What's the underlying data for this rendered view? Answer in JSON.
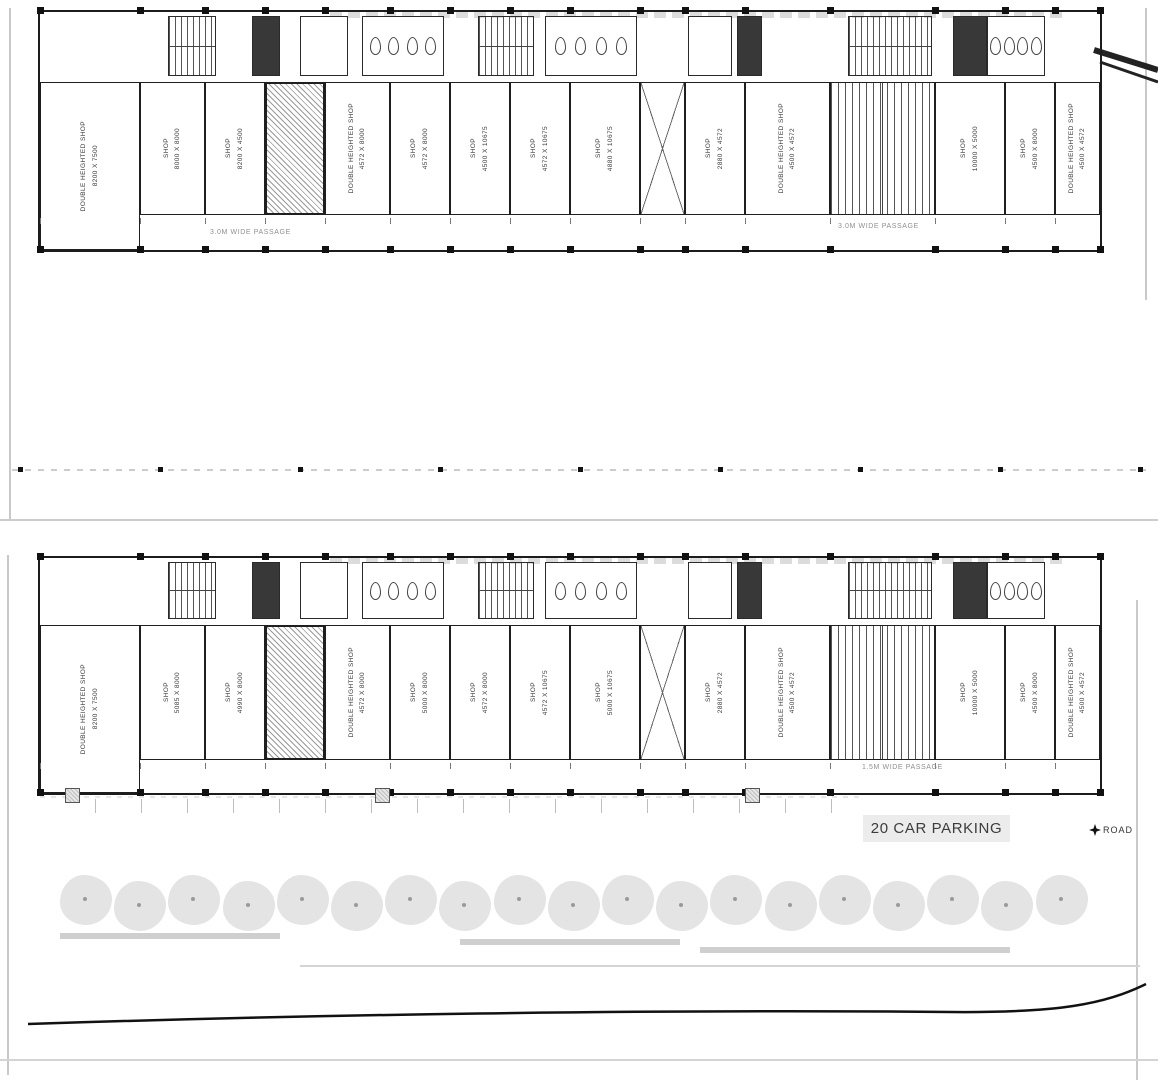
{
  "meta": {
    "drawing_type": "architectural floor plan",
    "description": "Two stacked floor plans of a commercial shop row building with stairs, lifts, toilets, front passage, car parking, tree line and road"
  },
  "colors": {
    "wall": "#1c1c1c",
    "boundary": "#c9c9c9",
    "tree_fill": "#e4e4e4",
    "label_text": "#3a3a3a",
    "passage_text": "#8f8f8f"
  },
  "floors": [
    {
      "name": "upper floor plan",
      "units": [
        {
          "type": "shop-dh",
          "label": "DOUBLE HEIGHTED SHOP",
          "dim": "8200 X 7500"
        },
        {
          "type": "shop",
          "label": "SHOP",
          "dim": "8000 X 8000"
        },
        {
          "type": "shop",
          "label": "SHOP",
          "dim": "8200 X 4500"
        },
        {
          "type": "lift",
          "label": "",
          "dim": ""
        },
        {
          "type": "shop-dh",
          "label": "DOUBLE HEIGHTED SHOP",
          "dim": "4572 X 8000"
        },
        {
          "type": "shop",
          "label": "SHOP",
          "dim": "4572 X 8000"
        },
        {
          "type": "shop",
          "label": "SHOP",
          "dim": "4500 X 10675"
        },
        {
          "type": "shop",
          "label": "SHOP",
          "dim": "4572 X 10675"
        },
        {
          "type": "shop",
          "label": "SHOP",
          "dim": "4880 X 10675"
        },
        {
          "type": "entry",
          "label": "",
          "dim": ""
        },
        {
          "type": "shop",
          "label": "SHOP",
          "dim": "2880 X 4572"
        },
        {
          "type": "shop-dh",
          "label": "DOUBLE HEIGHTED SHOP",
          "dim": "4500 X 4572"
        },
        {
          "type": "stair",
          "label": "",
          "dim": ""
        },
        {
          "type": "shop",
          "label": "SHOP",
          "dim": "10000 X 5000"
        },
        {
          "type": "shop",
          "label": "SHOP",
          "dim": "4500 X 8000"
        },
        {
          "type": "shop-dh",
          "label": "DOUBLE HEIGHTED SHOP",
          "dim": "4500 X 4572"
        }
      ],
      "passage_labels": [
        "3.0M WIDE PASSAGE",
        "3.0M WIDE PASSAGE"
      ]
    },
    {
      "name": "ground floor plan",
      "units": [
        {
          "type": "shop-dh",
          "label": "DOUBLE HEIGHTED SHOP",
          "dim": "8200 X 7500"
        },
        {
          "type": "shop",
          "label": "SHOP",
          "dim": "5085 X 8000"
        },
        {
          "type": "shop",
          "label": "SHOP",
          "dim": "4990 X 8000"
        },
        {
          "type": "lift",
          "label": "",
          "dim": ""
        },
        {
          "type": "shop-dh",
          "label": "DOUBLE HEIGHTED SHOP",
          "dim": "4572 X 8000"
        },
        {
          "type": "shop",
          "label": "SHOP",
          "dim": "5000 X 8000"
        },
        {
          "type": "shop",
          "label": "SHOP",
          "dim": "4572 X 8000"
        },
        {
          "type": "shop",
          "label": "SHOP",
          "dim": "4572 X 10675"
        },
        {
          "type": "shop",
          "label": "SHOP",
          "dim": "5000 X 10675"
        },
        {
          "type": "entry",
          "label": "",
          "dim": ""
        },
        {
          "type": "shop",
          "label": "SHOP",
          "dim": "2880 X 4572"
        },
        {
          "type": "shop-dh",
          "label": "DOUBLE HEIGHTED SHOP",
          "dim": "4500 X 4572"
        },
        {
          "type": "stair",
          "label": "",
          "dim": ""
        },
        {
          "type": "shop",
          "label": "SHOP",
          "dim": "10000 X 5000"
        },
        {
          "type": "shop",
          "label": "SHOP",
          "dim": "4500 X 8000"
        },
        {
          "type": "shop-dh",
          "label": "DOUBLE HEIGHTED SHOP",
          "dim": "4500 X 4572"
        }
      ],
      "passage_labels": [
        "1.5M WIDE PASSAGE"
      ]
    }
  ],
  "site": {
    "parking_label": "20 CAR PARKING",
    "road_label": "ROAD",
    "tree_count": 19
  }
}
